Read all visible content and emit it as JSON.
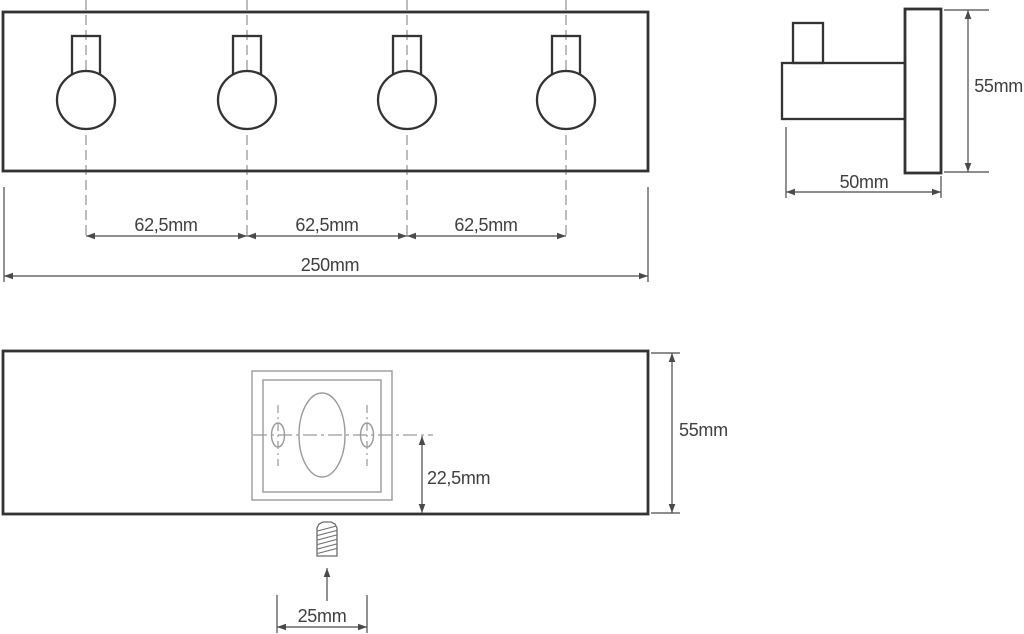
{
  "front_view": {
    "hook_count": 4,
    "spacing_dims": [
      {
        "label": "62,5mm"
      },
      {
        "label": "62,5mm"
      },
      {
        "label": "62,5mm"
      }
    ],
    "total_width_dim": {
      "label": "250mm"
    }
  },
  "side_view": {
    "height_dim": {
      "label": "55mm"
    },
    "depth_dim": {
      "label": "50mm"
    }
  },
  "back_view": {
    "height_dim": {
      "label": "55mm"
    },
    "hole_offset_dim": {
      "label": "22,5mm"
    },
    "screw_offset_dim": {
      "label": "25mm"
    }
  },
  "colors": {
    "background": "#ffffff",
    "outline": "#333333",
    "centerline": "#9a9a9a",
    "dimension": "#4a4a4a",
    "text": "#3f3f3f"
  }
}
